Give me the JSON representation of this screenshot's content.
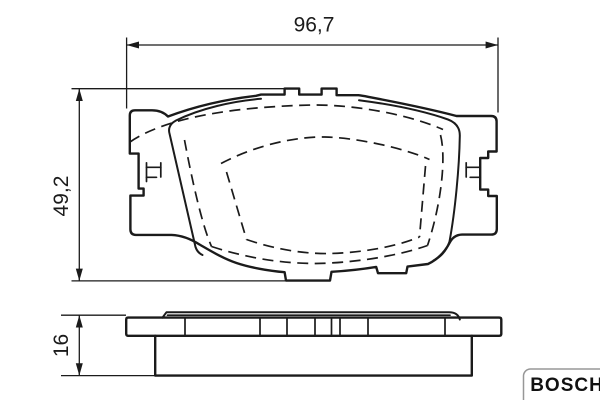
{
  "drawing": {
    "part_name": "disc brake pad technical drawing",
    "background": "#ffffff",
    "line_color": "#1b1b1b",
    "dimensions": {
      "width": "96,7",
      "height": "49,2",
      "thickness": "16"
    },
    "brand": {
      "logo": "BOSCH",
      "border_color": "#979797"
    }
  }
}
